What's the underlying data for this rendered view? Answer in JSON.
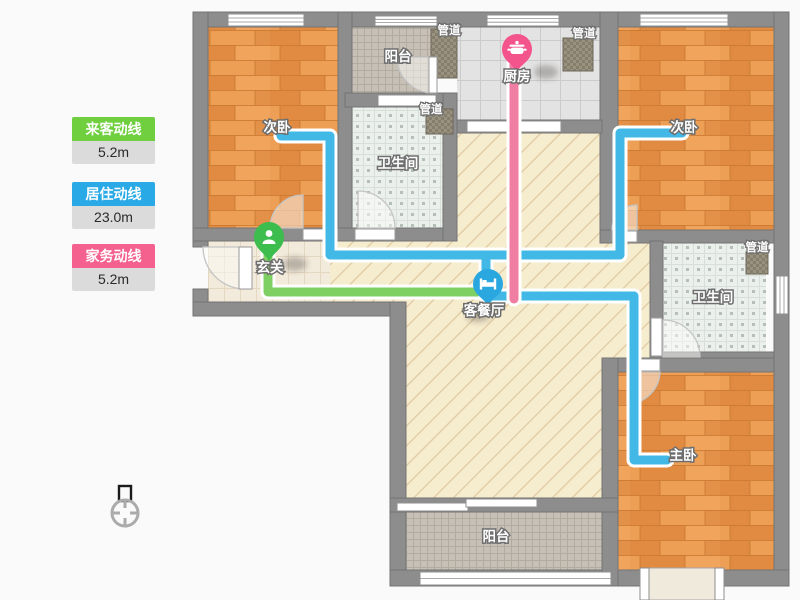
{
  "page": {
    "background": "#FAFAFA",
    "title": "户型动线图"
  },
  "legend": {
    "items": [
      {
        "id": "visitor",
        "label": "来客动线",
        "value": "5.2m",
        "color": "#6FCF3F"
      },
      {
        "id": "resident",
        "label": "居住动线",
        "value": "23.0m",
        "color": "#29A9E5"
      },
      {
        "id": "chore",
        "label": "家务动线",
        "value": "5.2m",
        "color": "#F4618E"
      }
    ]
  },
  "rooms": {
    "bedroom_left": "次卧",
    "bedroom_right": "次卧",
    "master_bedroom": "主卧",
    "balcony_top": "阳台",
    "balcony_bottom": "阳台",
    "kitchen": "厨房",
    "bathroom_top": "卫生间",
    "bathroom_right": "卫生间",
    "entrance": "玄关",
    "living_dining": "客餐厅",
    "duct": "管道"
  },
  "routes": {
    "visitor": {
      "label": "来客动线",
      "color": "#7ED063",
      "length": "5.2m"
    },
    "resident": {
      "label": "居住动线",
      "color": "#41B8E6",
      "length": "23.0m"
    },
    "chore": {
      "label": "家务动线",
      "color": "#F07EA3",
      "length": "5.2m"
    }
  },
  "pins": {
    "entrance": {
      "room": "玄关",
      "color": "#3CBD4E",
      "icon": "person-icon"
    },
    "kitchen": {
      "room": "厨房",
      "color": "#F4548C",
      "icon": "pot-icon"
    },
    "living": {
      "room": "客餐厅",
      "color": "#2BA7E0",
      "icon": "bed-icon"
    }
  },
  "icons": {
    "compass": "north-compass-icon"
  },
  "palette": {
    "wall": "#8D8D8D",
    "wood_floor": "#E8964E",
    "corridor_floor": "#F6ECCE",
    "bath_tile": "#EBF0EC",
    "kitchen_tile": "#E3E3E3",
    "balcony_tile": "#C7C0B6"
  }
}
